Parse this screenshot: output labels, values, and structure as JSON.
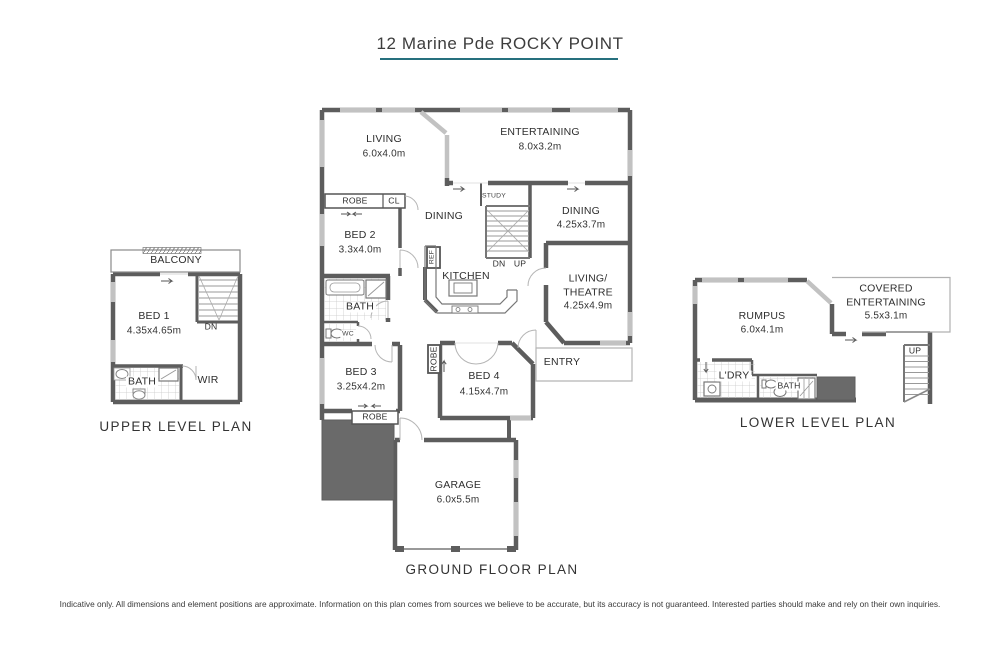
{
  "title": "12 Marine Pde ROCKY POINT",
  "footer": "Indicative only. All dimensions and element positions are approximate. Information on this plan comes from sources we believe to be accurate, but its accuracy is not guaranteed. Interested parties should make and rely on their own inquiries.",
  "colors": {
    "accent_teal": "#26707e",
    "wall_gray": "#5d5d5d",
    "window_gray": "#c2c2c2",
    "solid_mass_gray": "#6a6a6a"
  },
  "upper": {
    "title": "UPPER LEVEL PLAN",
    "labels": {
      "balcony": "BALCONY",
      "bed1": "BED 1",
      "bed1_dims": "4.35x4.65m",
      "dn": "DN",
      "bath": "BATH",
      "wir": "WIR"
    }
  },
  "ground": {
    "title": "GROUND FLOOR PLAN",
    "labels": {
      "living": "LIVING",
      "living_dims": "6.0x4.0m",
      "entertaining": "ENTERTAINING",
      "entertaining_dims": "8.0x3.2m",
      "robe1": "ROBE",
      "cl": "CL",
      "dining1": "DINING",
      "study": "STUDY",
      "dining2": "DINING",
      "dining2_dims": "4.25x3.7m",
      "bed2": "BED 2",
      "bed2_dims": "3.3x4.0m",
      "ref": "REF",
      "kitchen": "KITCHEN",
      "dn": "DN",
      "up": "UP",
      "living_theatre": "LIVING/\nTHEATRE",
      "living_theatre_dims": "4.25x4.9m",
      "bath": "BATH",
      "wc": "WC",
      "bed3": "BED 3",
      "bed3_dims": "3.25x4.2m",
      "robe2": "ROBE",
      "bed4": "BED 4",
      "bed4_dims": "4.15x4.7m",
      "entry": "ENTRY",
      "robe3": "ROBE",
      "garage": "GARAGE",
      "garage_dims": "6.0x5.5m"
    }
  },
  "lower": {
    "title": "LOWER LEVEL PLAN",
    "labels": {
      "rumpus": "RUMPUS",
      "rumpus_dims": "6.0x4.1m",
      "covered": "COVERED\nENTERTAINING",
      "covered_dims": "5.5x3.1m",
      "ldry": "L'DRY",
      "bath": "BATH",
      "up": "UP"
    }
  }
}
